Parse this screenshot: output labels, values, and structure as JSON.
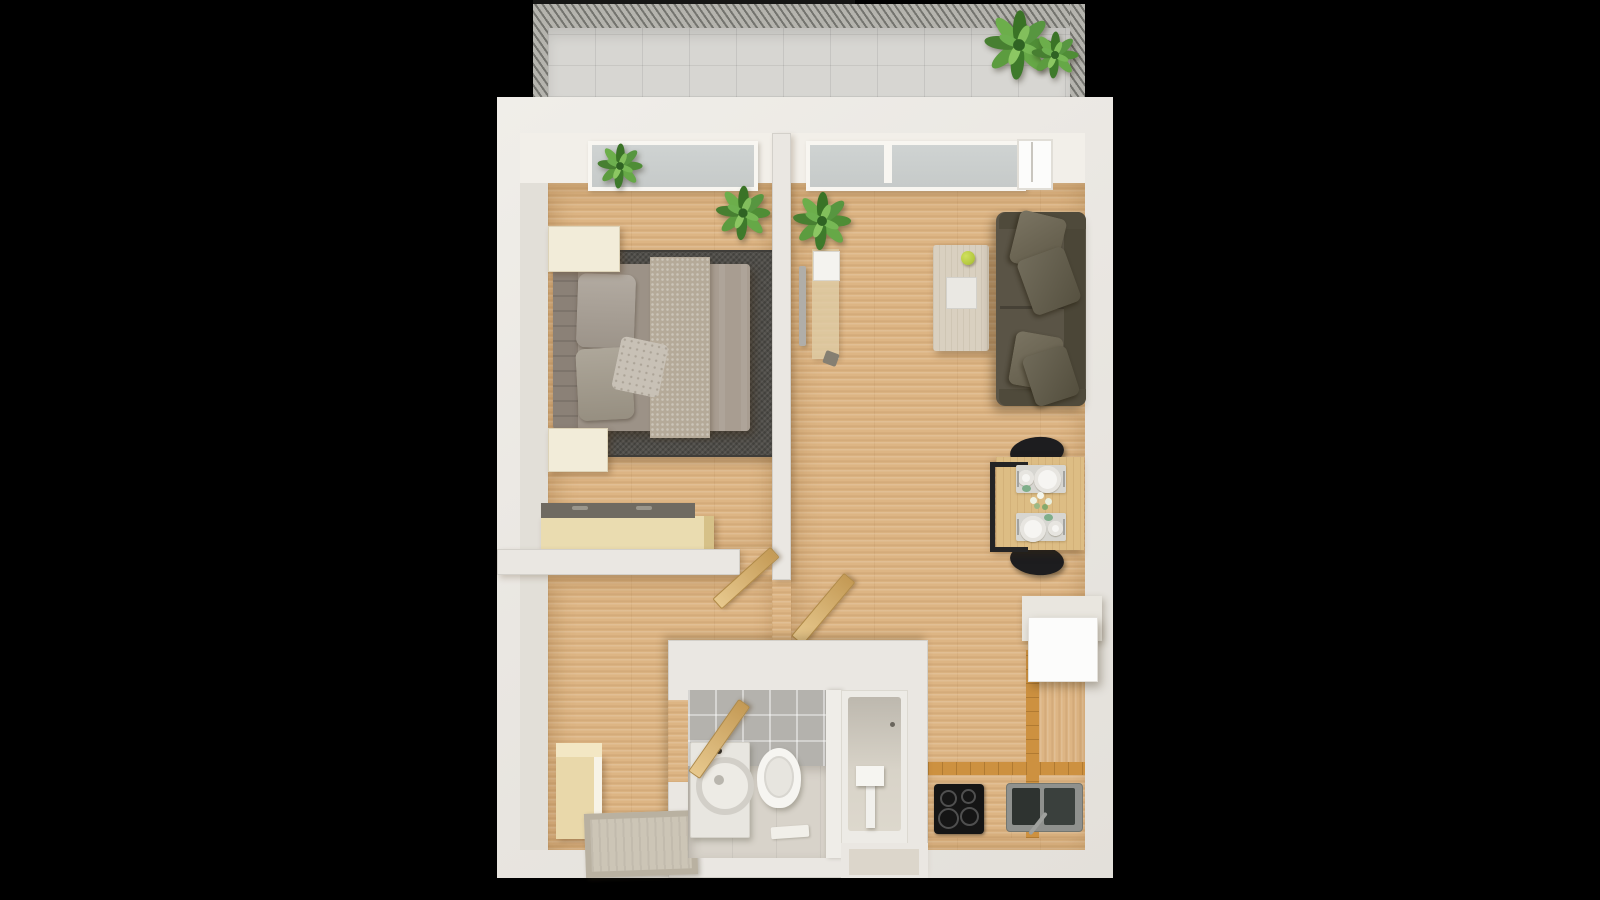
{
  "scene": {
    "type": "3d-floor-plan-top-view",
    "description": "Top-down 3D render of a one-bedroom apartment floor plan with balcony, on a black background",
    "background": "#000000"
  },
  "colors": {
    "bg": "#000000",
    "wall": "#eae7e2",
    "wall-face": "#f2efe9",
    "wall-side": "#e2dfd8",
    "wood": "#ddb584",
    "balcony-tile": "#d7d6d2",
    "railing": "#b5b4ae",
    "glass": "#c6cac9",
    "rug": "#514f4a",
    "bed-base": "#9c9287",
    "headboard": "#8b8177",
    "duvet": "#a89d91",
    "runner": "#b5aa99",
    "pillow": "#a69d92",
    "pillow-accent": "#c8c1b6",
    "nightstand": "#f2ecd9",
    "chest-top": "#6f6a61",
    "chest-body": "#eadcb0",
    "door-wood": "#d9b678",
    "tv": "#b0aea9",
    "sofa": "#5a5446",
    "sofa-dark": "#4b4637",
    "cushion": "#6b6450",
    "coffee-table": "#d9d0c0",
    "tray": "#eae8e3",
    "apple": "#b5c93f",
    "dining-table": "#ddbd84",
    "chair": "#1d1d1f",
    "placemat": "#d7d6d1",
    "plate": "#f6f5f2",
    "counter-edge": "#cd9140",
    "cooktop": "#151515",
    "sink": "#8f918e",
    "basin": "#2e3330",
    "cabinet": "#fcfcfb",
    "tile-grey": "#b4b2ad",
    "bath-floor": "#d8d3ca",
    "fixture": "#f6f5f1",
    "washer": "#e8e6e0",
    "mat-beige": "#ccc5b6",
    "wardrobe": "#e9d8aa",
    "leaf-green": "#4f8d36"
  },
  "rooms": [
    {
      "id": "balcony",
      "label": "Balcony",
      "items": [
        "tiled floor",
        "hatched railing",
        "large potted plant",
        "small potted plant"
      ]
    },
    {
      "id": "bedroom",
      "label": "Bedroom",
      "items": [
        "window",
        "windowsill plant",
        "corner plant",
        "double bed",
        "headboard",
        "two pillows",
        "accent pillow",
        "knit runner",
        "dark area rug",
        "nightstand top",
        "nightstand bottom",
        "storage chest",
        "open door"
      ]
    },
    {
      "id": "living-room",
      "label": "Living room",
      "items": [
        "window",
        "balcony door",
        "wall TV",
        "media console",
        "coffee table with tray and apple",
        "sofa with four cushions",
        "dining table",
        "two black chairs",
        "two place settings",
        "flower centerpiece",
        "open door",
        "potted plant"
      ]
    },
    {
      "id": "hallway",
      "label": "Hallway",
      "items": [
        "wardrobe",
        "doormat"
      ]
    },
    {
      "id": "bathroom",
      "label": "Bathroom",
      "items": [
        "grey tiled wall",
        "washing machine",
        "toilet",
        "bath mat",
        "bathtub",
        "faucet",
        "partition wall",
        "open wooden door"
      ]
    },
    {
      "id": "kitchen",
      "label": "Kitchen",
      "items": [
        "L-shaped wood counter",
        "induction cooktop with four burners",
        "double stainless sink",
        "white upper cabinet"
      ]
    }
  ],
  "counts": {
    "dining_chairs": 2,
    "place_settings": 2,
    "sofa_cushions": 4,
    "cooktop_burners": 4,
    "plants": 5
  }
}
